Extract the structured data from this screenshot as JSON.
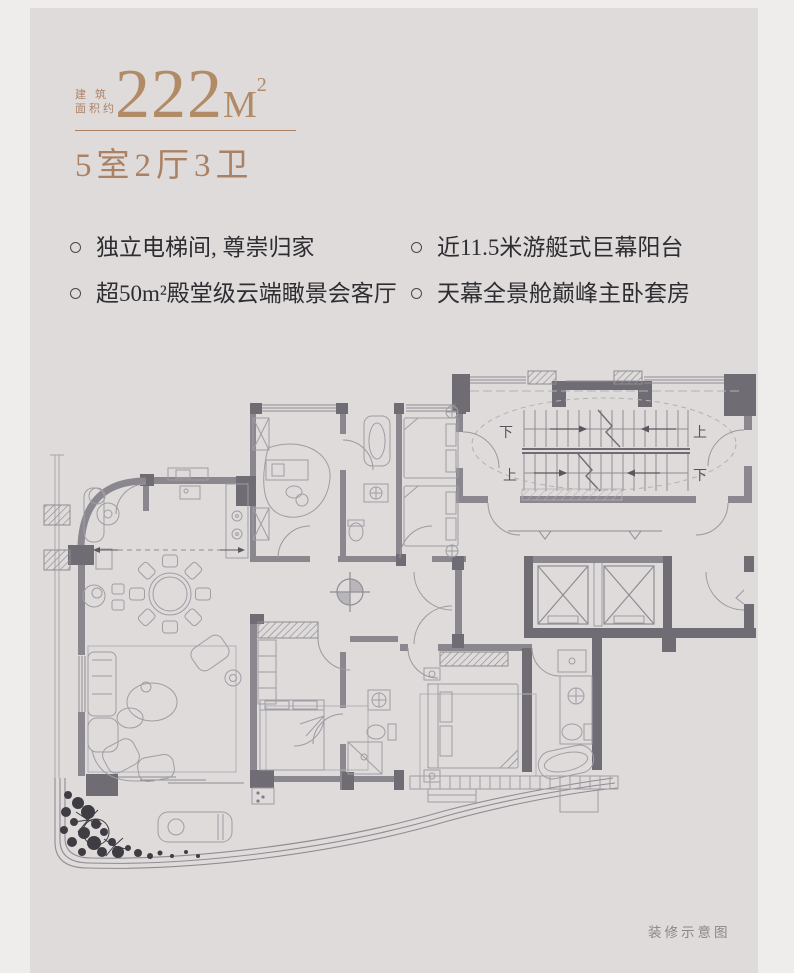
{
  "header": {
    "area_label_line1": "建 筑",
    "area_label_line2": "面积约",
    "area_value": "222",
    "area_unit": "M",
    "area_sup": "2",
    "layout": "5室2厅3卫",
    "accent_color": "#ab8164"
  },
  "features": {
    "items": [
      {
        "text": "独立电梯间, 尊崇归家"
      },
      {
        "text": "近11.5米游艇式巨幕阳台"
      },
      {
        "text": "超50m²殿堂级云端瞰景会客厅"
      },
      {
        "text": "天幕全景舱巅峰主卧套房"
      }
    ]
  },
  "plan": {
    "stair_labels": {
      "down1": "下",
      "up1": "上",
      "up2": "上",
      "down2": "下"
    },
    "caption": "装修示意图",
    "colors": {
      "canvas": "#dedbda",
      "frame": "#efedec",
      "wall": "#8a878e",
      "pier": "#6f6c74",
      "line": "#8f8c93",
      "furniture": "#a09da4",
      "plant": "#3f3d43",
      "text": "#2e2d31"
    }
  }
}
